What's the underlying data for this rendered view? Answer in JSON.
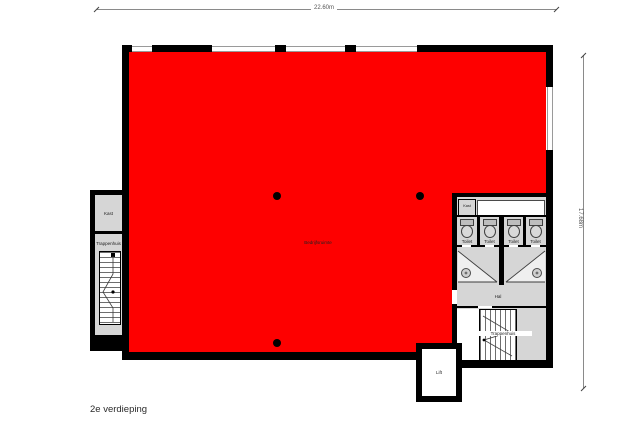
{
  "title": "2e verdieping",
  "dimensions": {
    "top": "22.60m",
    "right": "17.68m"
  },
  "rooms": {
    "main": "Bedrijfsruimte",
    "kast_left": "Kast",
    "trappenhuis_left": "Trappenhuis",
    "kast_right": "Kast",
    "toilets": [
      "Toilet",
      "Toilet",
      "Toilet",
      "Toilet"
    ],
    "hal": "Hal",
    "trappenhuis_right": "Trappenhuis",
    "lift": "Lift"
  },
  "colors": {
    "highlight": "#fe0000",
    "room_fill": "#d6d6d6",
    "wall": "#000000",
    "window": "#9a9a9a"
  }
}
